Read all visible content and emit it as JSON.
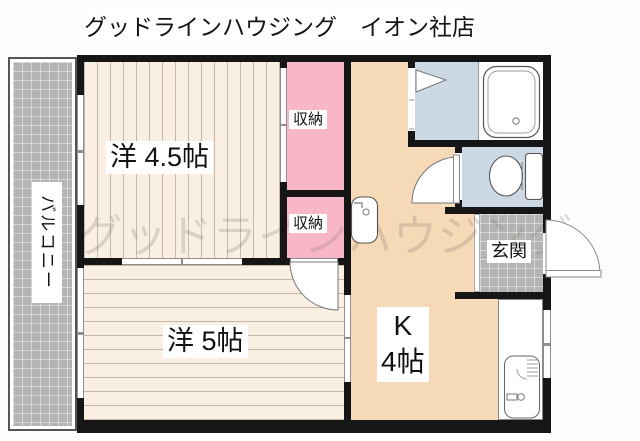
{
  "title": "グッドラインハウジング　イオン社店",
  "watermark": "グッドラインハウジング",
  "rooms": {
    "western45": {
      "label": "洋 4.5帖"
    },
    "western5": {
      "label": "洋 5帖"
    },
    "kitchen": {
      "label_k": "K",
      "label_size": "4帖"
    },
    "closet_top": {
      "label": "収納"
    },
    "closet_bottom": {
      "label": "収納"
    },
    "entrance": {
      "label": "玄関"
    },
    "balcony": {
      "label": "バルコニー"
    }
  },
  "colors": {
    "wall": "#161616",
    "wood_floor": "#f9efe2",
    "kitchen_floor": "#f6d9b6",
    "closet_pink": "#f8b7c9",
    "wet_area_blue": "#ccd9e4",
    "tile_gray": "#b4b4b4"
  }
}
